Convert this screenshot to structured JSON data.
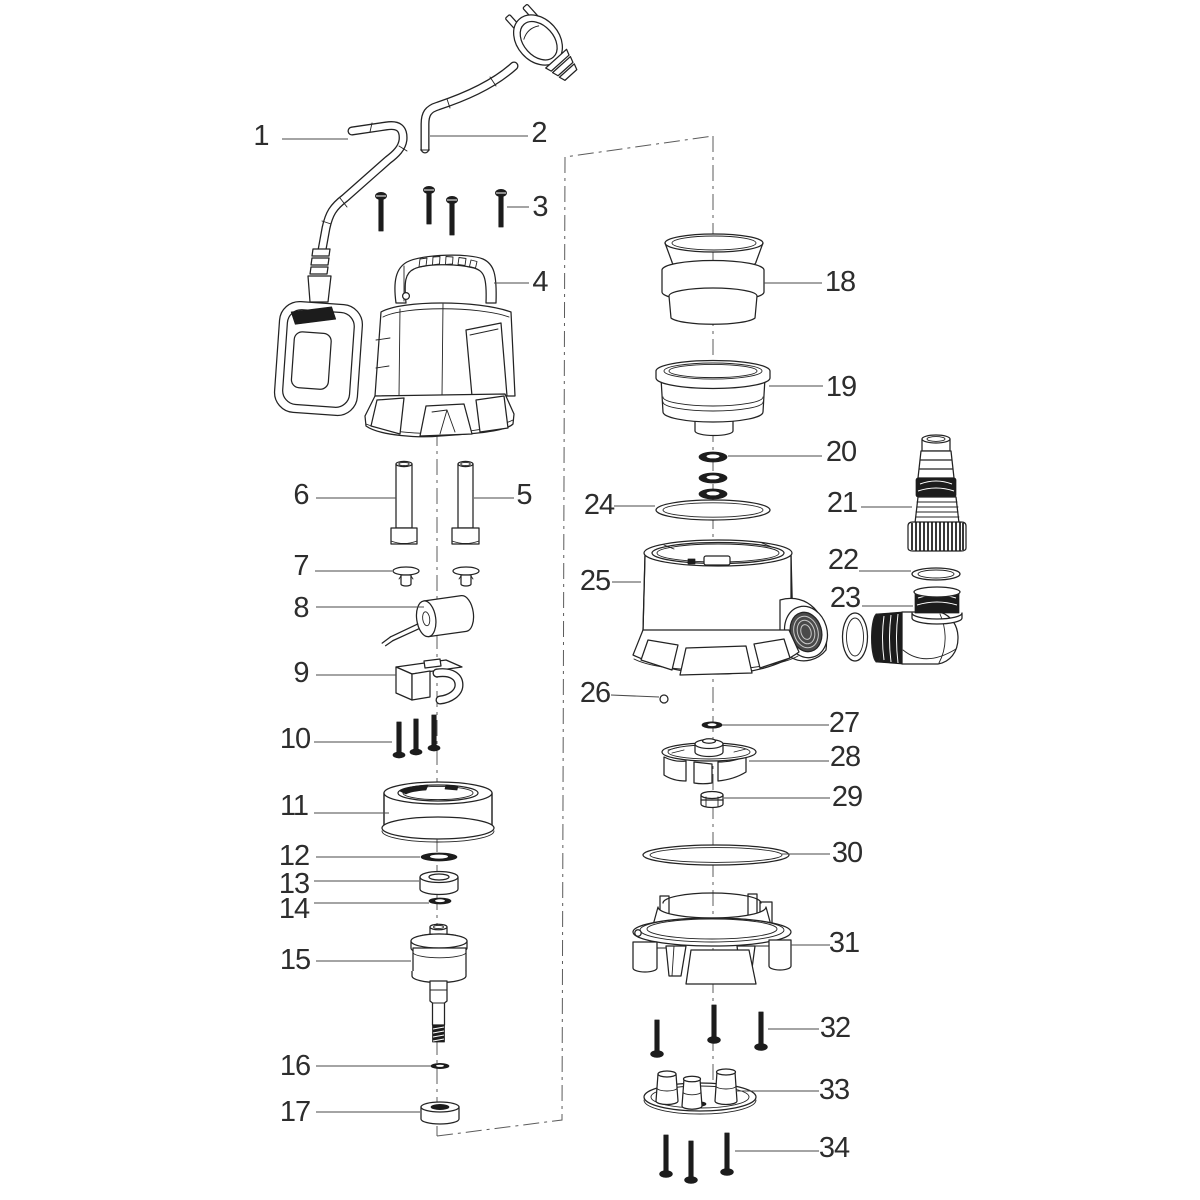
{
  "diagram": {
    "palette": {
      "ink": "#232323",
      "leader": "#4a4a4a",
      "construction": "#5b5b5b",
      "background": "#ffffff"
    },
    "labels": [
      {
        "num": "1",
        "x": 261,
        "y": 136,
        "leader": [
          282,
          139,
          348,
          139
        ]
      },
      {
        "num": "2",
        "x": 539,
        "y": 133,
        "leader": [
          430,
          136,
          528,
          136
        ]
      },
      {
        "num": "3",
        "x": 540,
        "y": 207,
        "leader": [
          507,
          207,
          529,
          207
        ]
      },
      {
        "num": "4",
        "x": 540,
        "y": 282,
        "leader": [
          494,
          283,
          529,
          283
        ]
      },
      {
        "num": "5",
        "x": 524,
        "y": 495,
        "leader": [
          474,
          498,
          514,
          498
        ]
      },
      {
        "num": "6",
        "x": 301,
        "y": 495,
        "leader": [
          316,
          498,
          396,
          498
        ]
      },
      {
        "num": "7",
        "x": 301,
        "y": 566,
        "leader": [
          315,
          571,
          392,
          571
        ]
      },
      {
        "num": "8",
        "x": 301,
        "y": 608,
        "leader": [
          316,
          607,
          424,
          607
        ]
      },
      {
        "num": "9",
        "x": 301,
        "y": 673,
        "leader": [
          316,
          675,
          396,
          675
        ]
      },
      {
        "num": "10",
        "x": 295,
        "y": 739,
        "leader": [
          314,
          742,
          392,
          742
        ]
      },
      {
        "num": "11",
        "x": 294,
        "y": 806,
        "leader": [
          314,
          813,
          389,
          813
        ]
      },
      {
        "num": "12",
        "x": 294,
        "y": 856,
        "leader": [
          316,
          857,
          420,
          857
        ]
      },
      {
        "num": "13",
        "x": 294,
        "y": 884,
        "leader": [
          314,
          881,
          419,
          881
        ]
      },
      {
        "num": "14",
        "x": 294,
        "y": 909,
        "leader": [
          314,
          903,
          429,
          903
        ]
      },
      {
        "num": "15",
        "x": 295,
        "y": 960,
        "leader": [
          316,
          961,
          411,
          961
        ]
      },
      {
        "num": "16",
        "x": 295,
        "y": 1066,
        "leader": [
          316,
          1066,
          431,
          1066
        ]
      },
      {
        "num": "17",
        "x": 295,
        "y": 1112,
        "leader": [
          316,
          1112,
          420,
          1112
        ]
      },
      {
        "num": "18",
        "x": 840,
        "y": 282,
        "leader": [
          764,
          283,
          822,
          283
        ]
      },
      {
        "num": "19",
        "x": 841,
        "y": 387,
        "leader": [
          769,
          386,
          823,
          386
        ]
      },
      {
        "num": "20",
        "x": 841,
        "y": 452,
        "leader": [
          728,
          456,
          822,
          456
        ]
      },
      {
        "num": "21",
        "x": 842,
        "y": 503,
        "leader": [
          861,
          507,
          912,
          507
        ]
      },
      {
        "num": "22",
        "x": 843,
        "y": 560,
        "leader": [
          859,
          571,
          911,
          571
        ]
      },
      {
        "num": "23",
        "x": 845,
        "y": 598,
        "leader": [
          862,
          606,
          913,
          606
        ]
      },
      {
        "num": "24",
        "x": 599,
        "y": 505,
        "leader": [
          614,
          506,
          655,
          506
        ]
      },
      {
        "num": "25",
        "x": 595,
        "y": 581,
        "leader": [
          612,
          582,
          641,
          582
        ]
      },
      {
        "num": "26",
        "x": 595,
        "y": 693,
        "leader": [
          611,
          695,
          659,
          697
        ]
      },
      {
        "num": "27",
        "x": 844,
        "y": 723,
        "leader": [
          722,
          725,
          829,
          725
        ]
      },
      {
        "num": "28",
        "x": 845,
        "y": 757,
        "leader": [
          749,
          761,
          829,
          761
        ]
      },
      {
        "num": "29",
        "x": 847,
        "y": 797,
        "leader": [
          724,
          798,
          830,
          798
        ]
      },
      {
        "num": "30",
        "x": 847,
        "y": 853,
        "leader": [
          781,
          854,
          830,
          854
        ]
      },
      {
        "num": "31",
        "x": 844,
        "y": 943,
        "leader": [
          791,
          945,
          830,
          945
        ]
      },
      {
        "num": "32",
        "x": 835,
        "y": 1028,
        "leader": [
          768,
          1029,
          819,
          1029
        ]
      },
      {
        "num": "33",
        "x": 834,
        "y": 1090,
        "leader": [
          736,
          1091,
          819,
          1091
        ]
      },
      {
        "num": "34",
        "x": 834,
        "y": 1148,
        "leader": [
          735,
          1151,
          819,
          1151
        ]
      }
    ]
  }
}
